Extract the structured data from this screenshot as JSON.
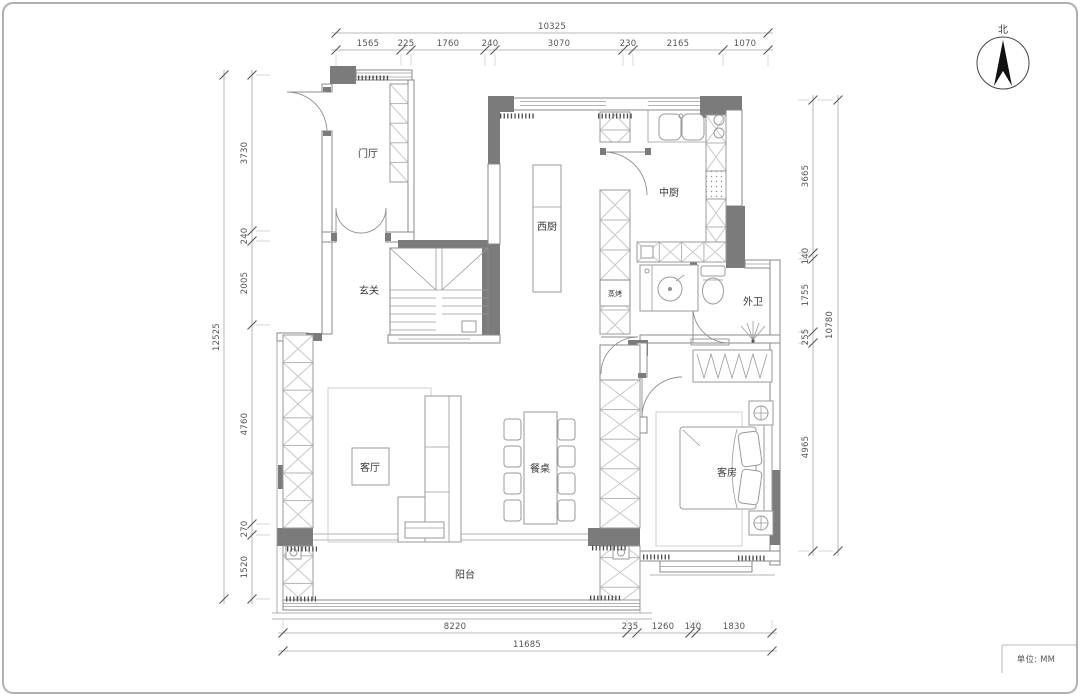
{
  "compass": {
    "north_label": "北"
  },
  "title_block": {
    "units_label": "单位: MM"
  },
  "rooms": {
    "entry_hall": "门厅",
    "vestibule": "玄关",
    "west_kitchen": "西厨",
    "chinese_kitchen": "中厨",
    "steam_oven_cabinet": "蒸烤",
    "guest_bathroom": "外卫",
    "living_room": "客厅",
    "dining_table": "餐桌",
    "guest_bedroom": "客房",
    "balcony": "阳台"
  },
  "dimensions": {
    "unit": "mm",
    "top": {
      "total": "10325",
      "segments": [
        "1565",
        "225",
        "1760",
        "240",
        "3070",
        "230",
        "2165",
        "1070"
      ]
    },
    "left": {
      "total": "12525",
      "segments": [
        "3730",
        "240",
        "2005",
        "4760",
        "270",
        "1520"
      ]
    },
    "right": {
      "total": "10780",
      "segments": [
        "3665",
        "140",
        "1755",
        "255",
        "4965"
      ]
    },
    "bottom": {
      "total": "11685",
      "segments": [
        "8220",
        "235",
        "1260",
        "140",
        "1830"
      ]
    }
  }
}
